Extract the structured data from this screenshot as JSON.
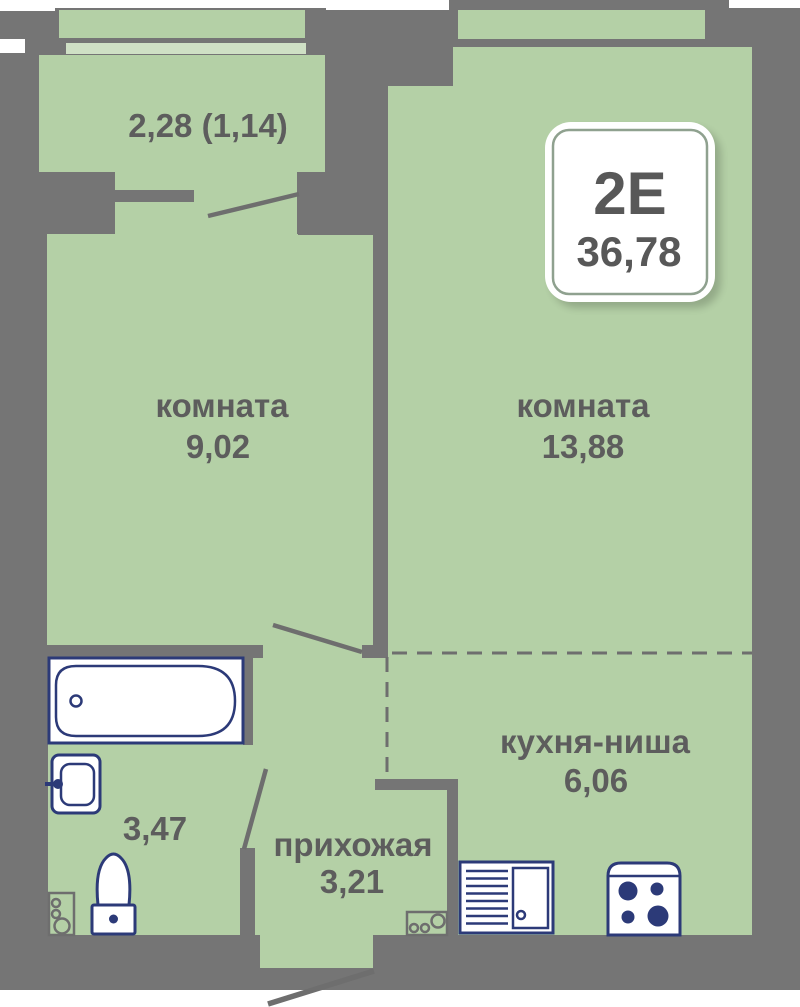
{
  "plan": {
    "badge": {
      "unit_type": "2Е",
      "total_area": "36,78"
    },
    "labels": {
      "balcony_area": "2,28 (1,14)",
      "room1_name": "комната",
      "room1_area": "9,02",
      "room2_name": "комната",
      "room2_area": "13,88",
      "kitchen_name": "кухня-ниша",
      "kitchen_area": "6,06",
      "hallway_name": "прихожая",
      "hallway_area": "3,21",
      "bathroom_area": "3,47"
    },
    "colors": {
      "wall": "#757575",
      "floor": "#b4d0a6",
      "window_glass": "#cfe0c5",
      "fixture_outline": "#2c3a78",
      "label_text": "#5d5d5d",
      "badge_border": "#8fa18f"
    }
  }
}
